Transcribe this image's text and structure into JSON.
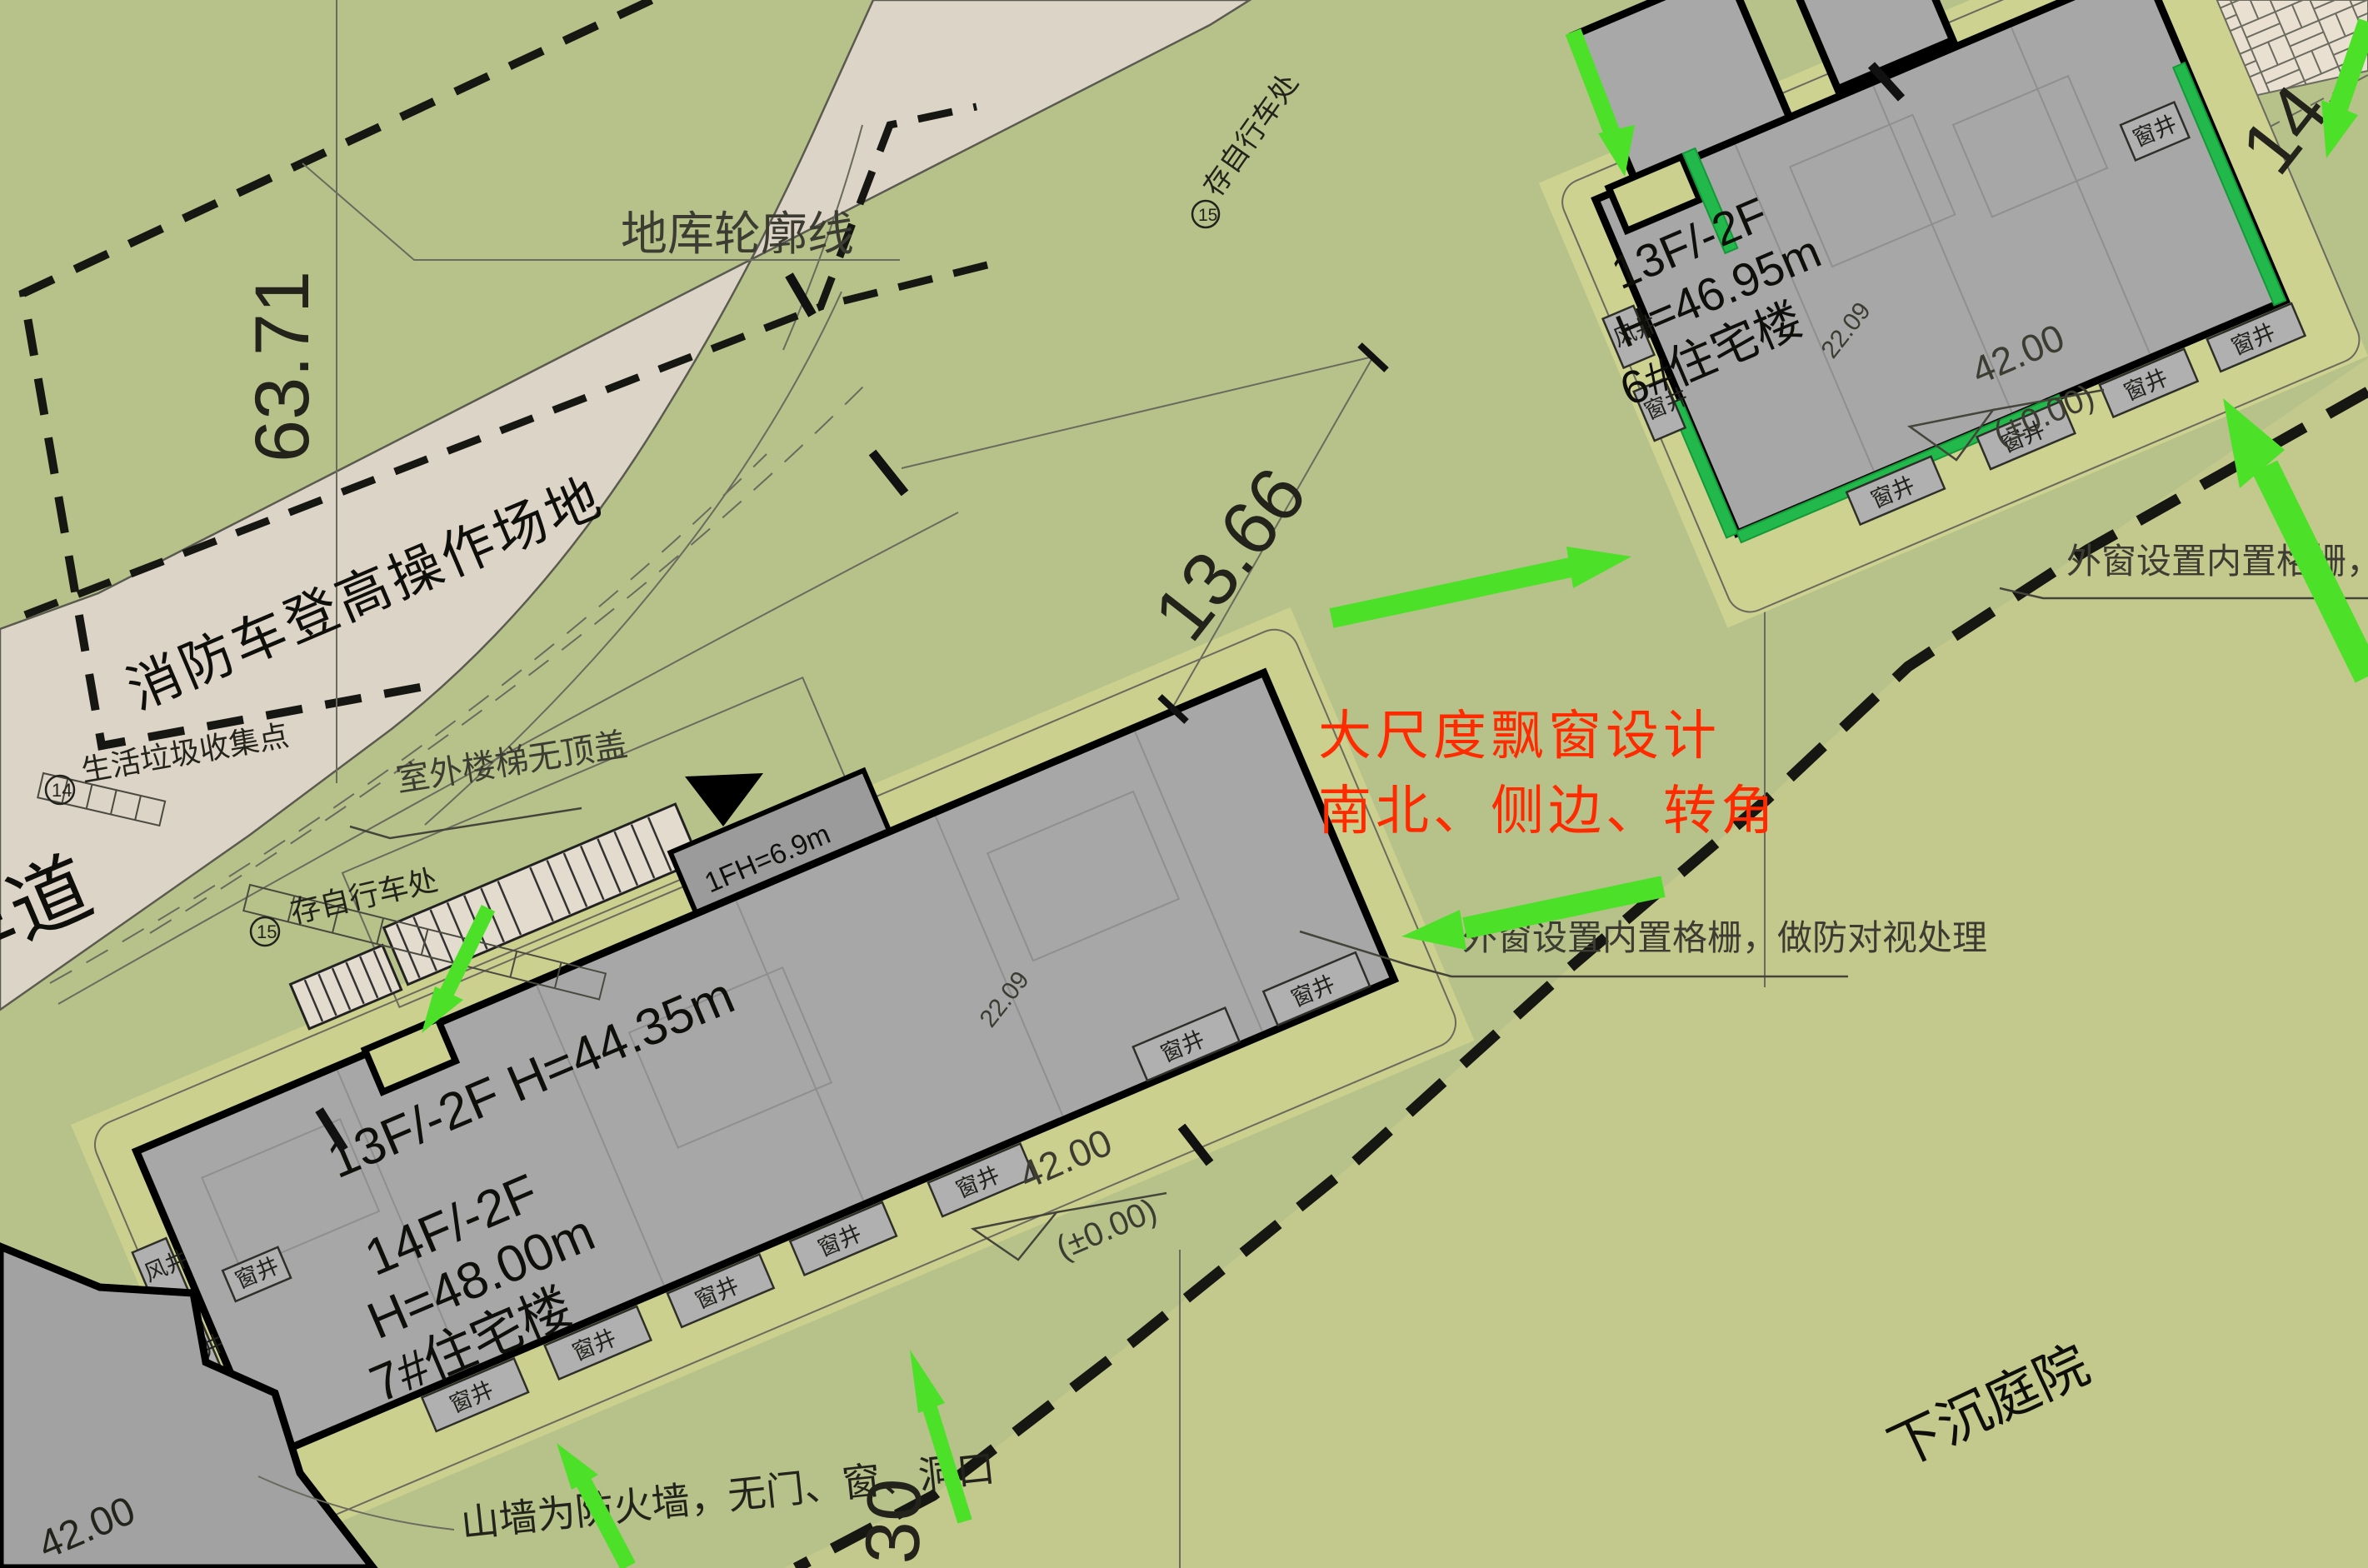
{
  "labels": {
    "window_well": "窗井",
    "vent_well": "风井",
    "basement_outline": "地库轮廓线",
    "fire_lane": "消防车登高操作场地",
    "lane": "车道",
    "waste_point": "生活垃圾收集点",
    "bike_parking": "存自行车处",
    "stair_note": "室外楼梯无顶盖",
    "firewall_note": "山墙为防火墙，无门、窗、洞口",
    "sunken_courtyard": "下沉庭院",
    "louver_note_full": "外窗设置内置格栅，做防对视处理",
    "louver_note_short": "外窗设置内置格栅，"
  },
  "red_note": {
    "line1": "大尺度飘窗设计",
    "line2": "南北、侧边、转角"
  },
  "b6": {
    "floors": "13F/-2F",
    "height": "H=46.95m",
    "name": "6#住宅楼",
    "elev": "42.00",
    "elev_base": "(±0.00)",
    "dim": "22.09"
  },
  "b7": {
    "top_line": "13F/-2F  H=44.35m",
    "floors": "14F/-2F",
    "height": "H=48.00m",
    "name": "7#住宅楼",
    "wing": "1FH=6.9m",
    "elev": "42.00",
    "elev_base": "(±0.00)",
    "dim": "22.09"
  },
  "dims": {
    "basement_width": "63.71",
    "gap": "13.66",
    "right_edge": "14.",
    "bottom": "30",
    "corner_elev": "42.00"
  },
  "badges": {
    "waste": "14",
    "bike": "15"
  },
  "colors": {
    "background": "#b6c289",
    "road": "#dcd4c6",
    "building": "#a7a7a7",
    "highlight_green": "#22b84c",
    "arrow_green": "#4ce029",
    "annotation_red": "#ff2a00"
  }
}
